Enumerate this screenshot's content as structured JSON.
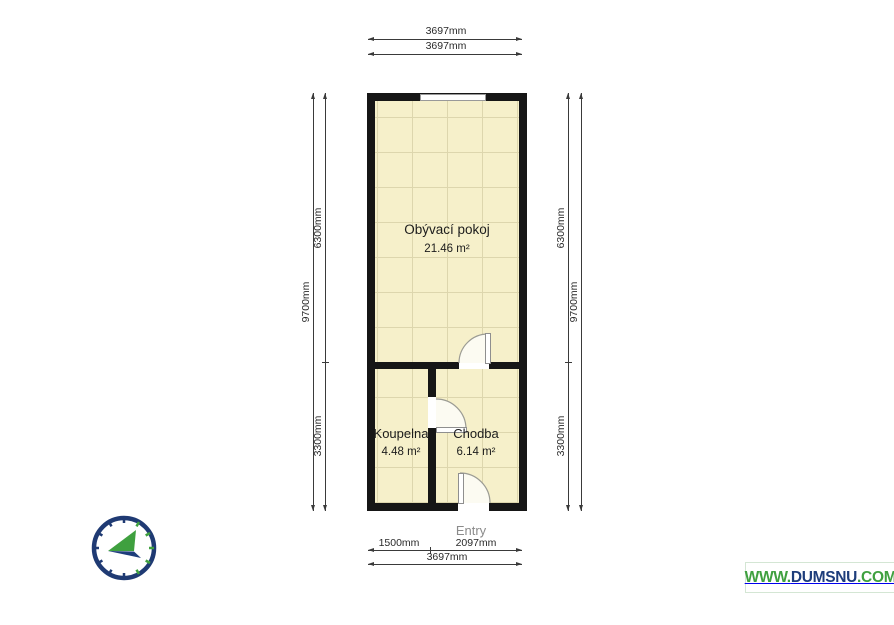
{
  "plan": {
    "rooms": [
      {
        "name": "Obývací pokoj",
        "area": "21.46 m²"
      },
      {
        "name": "Koupelna",
        "area": "4.48 m²"
      },
      {
        "name": "Chodba",
        "area": "6.14 m²"
      }
    ],
    "entry_label": "Entry"
  },
  "dimensions": {
    "top": {
      "line1": "3697mm",
      "line2": "3697mm"
    },
    "left": {
      "total": "9700mm",
      "upper": "6300mm",
      "lower": "3300mm"
    },
    "right": {
      "total": "9700mm",
      "upper": "6300mm",
      "lower": "3300mm"
    },
    "bottom": {
      "left_segment": "1500mm",
      "right_segment": "2097mm",
      "total": "3697mm"
    }
  },
  "watermark": {
    "prefix": "WWW.",
    "name": "DUMSNU",
    "suffix": ".COM"
  },
  "icons": {
    "compass": "compass-north-arrow"
  },
  "colors": {
    "floor": "#f6f0ca",
    "grid_line": "#ddd6ad",
    "wall": "#161616",
    "compass_navy": "#1f3a73",
    "compass_green": "#3fa03f",
    "watermark_green": "#3fa03f",
    "watermark_navy": "#1e3d7b",
    "entry_gray": "#8b8b8b"
  }
}
